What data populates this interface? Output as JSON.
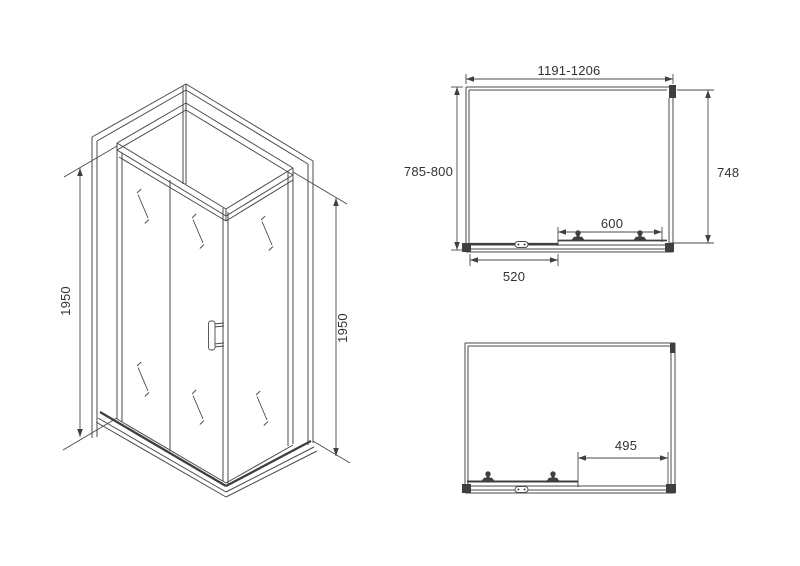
{
  "colors": {
    "background": "#ffffff",
    "line": "#4a4a4a",
    "text": "#333333",
    "dark_fill": "#3f3f3f"
  },
  "views": {
    "isometric": {
      "name": "corner-shower-enclosure-isometric",
      "dims": {
        "height_left": "1950",
        "height_right": "1950"
      }
    },
    "plan_top": {
      "name": "top-plan-door-closed",
      "dims": {
        "overall_width": "1191-1206",
        "overall_depth": "785-800",
        "side_panel": "748",
        "door_span": "600",
        "fixed_segment": "520"
      }
    },
    "plan_bottom": {
      "name": "top-plan-door-open",
      "dims": {
        "door_opening": "495"
      }
    }
  }
}
